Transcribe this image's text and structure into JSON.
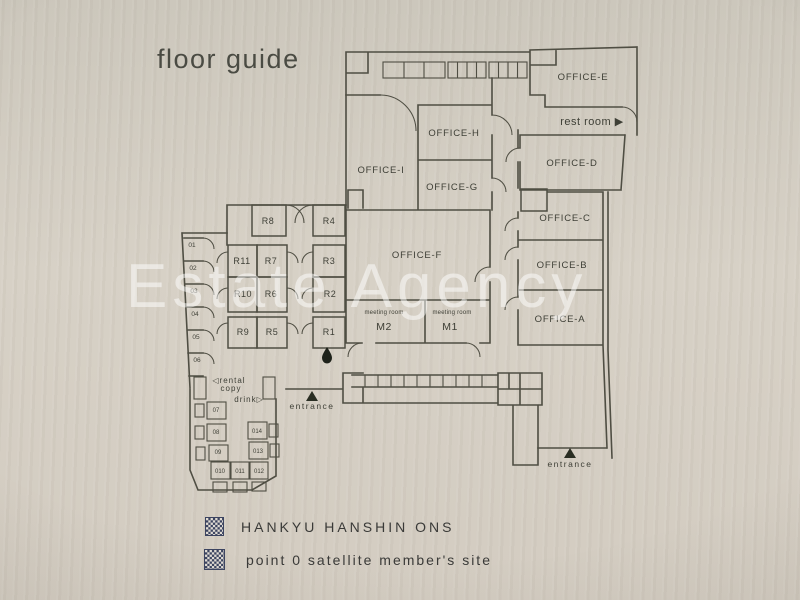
{
  "title": "floor guide",
  "watermark": "Estate Agency",
  "offices": {
    "a": "OFFICE-A",
    "b": "OFFICE-B",
    "c": "OFFICE-C",
    "d": "OFFICE-D",
    "e": "OFFICE-E",
    "f": "OFFICE-F",
    "g": "OFFICE-G",
    "h": "OFFICE-H",
    "i": "OFFICE-I"
  },
  "meeting": {
    "caption_m2": "meeting room",
    "m2": "M2",
    "caption_m1": "meeting room",
    "m1": "M1"
  },
  "rooms_r": {
    "r1": "R1",
    "r2": "R2",
    "r3": "R3",
    "r4": "R4",
    "r5": "R5",
    "r6": "R6",
    "r7": "R7",
    "r8": "R8",
    "r9": "R9",
    "r10": "R10",
    "r11": "R11"
  },
  "booths": {
    "b1": "01",
    "b2": "02",
    "b3": "03",
    "b4": "04",
    "b5": "05",
    "b6": "06",
    "b7": "07",
    "b8": "08",
    "b9": "09",
    "b10": "010",
    "b11": "011",
    "b12": "012",
    "b13": "013",
    "b14": "014"
  },
  "labels": {
    "rest_room": "rest room ▶",
    "rental": "◁rental",
    "copy": "copy",
    "drink": "drink▷",
    "entrance_main": "entrance",
    "entrance_side": "entrance"
  },
  "footer": {
    "qr1_text": "HANKYU HANSHIN ONS",
    "qr2_text": "point 0 satellite member's site"
  },
  "colors": {
    "wall_line": "#4f4e43",
    "label_text": "#3e3f36",
    "background": "#d2ccc1",
    "watermark": "rgba(255,255,255,0.5)",
    "entrance_marker": "#2a2e23",
    "water_drop": "#1e221a",
    "qr": "#3c4460"
  }
}
